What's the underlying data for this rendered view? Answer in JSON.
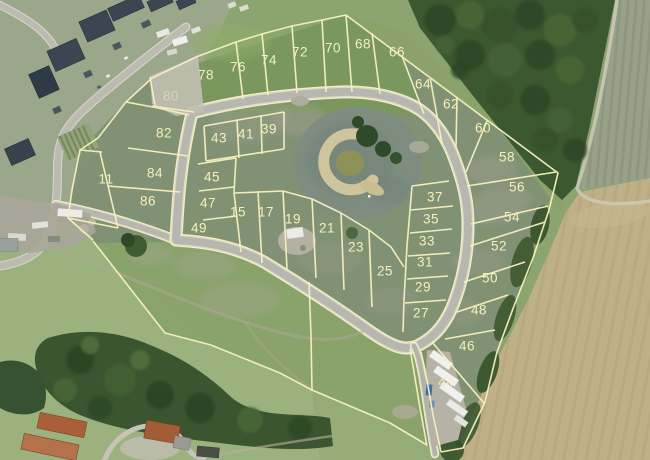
{
  "map": {
    "colors": {
      "label_color": "#f4f0bc",
      "boundary_color": "#f6f2be",
      "road_core": "#b8b7af",
      "road_edge": "#dbd8cd",
      "street_core": "#bcbbb2",
      "forest": "#3c5830",
      "field_tan": "#bfb087",
      "pond": "#7e8d80",
      "sand": "#cfc59d",
      "house_roof": "#3a4753",
      "barn_roof": "#a95f38",
      "grass_base": "#8ca470"
    },
    "lot_labels": [
      {
        "label": "80",
        "x": 171,
        "y": 96,
        "opacity": 0.5
      },
      {
        "label": "78",
        "x": 206,
        "y": 75,
        "opacity": 1
      },
      {
        "label": "76",
        "x": 238,
        "y": 67,
        "opacity": 1
      },
      {
        "label": "74",
        "x": 269,
        "y": 60,
        "opacity": 1
      },
      {
        "label": "72",
        "x": 300,
        "y": 52,
        "opacity": 1
      },
      {
        "label": "70",
        "x": 333,
        "y": 48,
        "opacity": 1
      },
      {
        "label": "68",
        "x": 363,
        "y": 44,
        "opacity": 1
      },
      {
        "label": "66",
        "x": 397,
        "y": 52,
        "opacity": 1
      },
      {
        "label": "64",
        "x": 423,
        "y": 84,
        "opacity": 1
      },
      {
        "label": "62",
        "x": 451,
        "y": 104,
        "opacity": 1
      },
      {
        "label": "60",
        "x": 483,
        "y": 128,
        "opacity": 1
      },
      {
        "label": "58",
        "x": 507,
        "y": 157,
        "opacity": 1
      },
      {
        "label": "56",
        "x": 517,
        "y": 187,
        "opacity": 1
      },
      {
        "label": "54",
        "x": 512,
        "y": 217,
        "opacity": 1
      },
      {
        "label": "52",
        "x": 499,
        "y": 246,
        "opacity": 1
      },
      {
        "label": "50",
        "x": 490,
        "y": 278,
        "opacity": 1
      },
      {
        "label": "48",
        "x": 479,
        "y": 310,
        "opacity": 1
      },
      {
        "label": "46",
        "x": 467,
        "y": 346,
        "opacity": 1
      },
      {
        "label": "44",
        "x": 446,
        "y": 382,
        "opacity": 0.9
      },
      {
        "label": "82",
        "x": 164,
        "y": 133,
        "opacity": 1
      },
      {
        "label": "84",
        "x": 155,
        "y": 173,
        "opacity": 1
      },
      {
        "label": "86",
        "x": 148,
        "y": 201,
        "opacity": 1
      },
      {
        "label": "11",
        "x": 106,
        "y": 179,
        "opacity": 1
      },
      {
        "label": "43",
        "x": 219,
        "y": 138,
        "opacity": 1
      },
      {
        "label": "41",
        "x": 246,
        "y": 134,
        "opacity": 1
      },
      {
        "label": "39",
        "x": 269,
        "y": 129,
        "opacity": 1
      },
      {
        "label": "45",
        "x": 212,
        "y": 177,
        "opacity": 1
      },
      {
        "label": "47",
        "x": 208,
        "y": 203,
        "opacity": 1
      },
      {
        "label": "49",
        "x": 199,
        "y": 228,
        "opacity": 1
      },
      {
        "label": "15",
        "x": 238,
        "y": 212,
        "opacity": 1
      },
      {
        "label": "17",
        "x": 266,
        "y": 212,
        "opacity": 1
      },
      {
        "label": "19",
        "x": 293,
        "y": 219,
        "opacity": 1
      },
      {
        "label": "21",
        "x": 327,
        "y": 228,
        "opacity": 1
      },
      {
        "label": "23",
        "x": 356,
        "y": 247,
        "opacity": 1
      },
      {
        "label": "25",
        "x": 385,
        "y": 271,
        "opacity": 1
      },
      {
        "label": "37",
        "x": 435,
        "y": 197,
        "opacity": 1
      },
      {
        "label": "35",
        "x": 431,
        "y": 219,
        "opacity": 1
      },
      {
        "label": "33",
        "x": 427,
        "y": 241,
        "opacity": 1
      },
      {
        "label": "31",
        "x": 425,
        "y": 262,
        "opacity": 1
      },
      {
        "label": "29",
        "x": 423,
        "y": 287,
        "opacity": 1
      },
      {
        "label": "27",
        "x": 421,
        "y": 313,
        "opacity": 1
      }
    ]
  }
}
